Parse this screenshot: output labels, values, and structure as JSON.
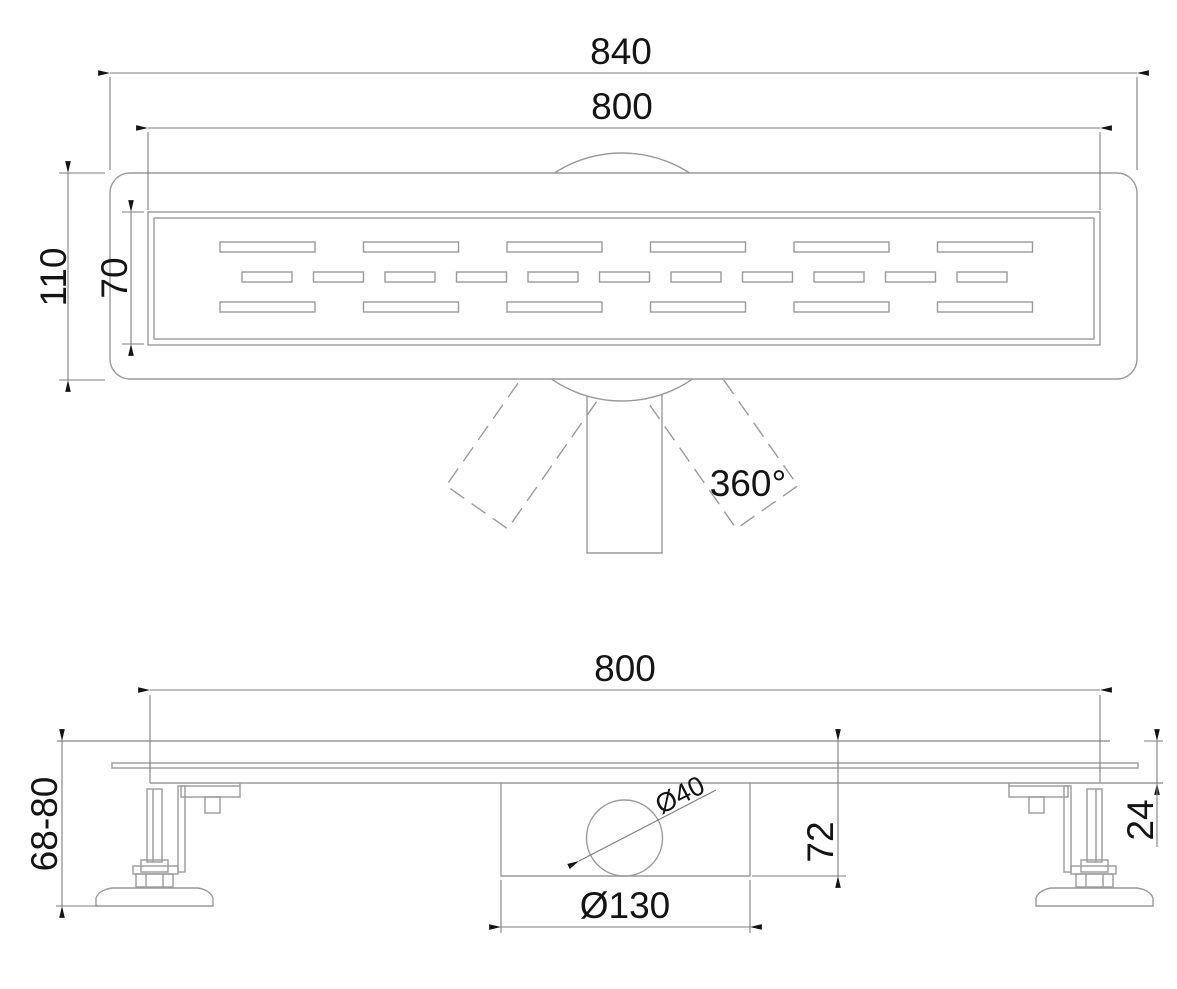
{
  "drawing": {
    "type": "technical-drawing",
    "subject": "linear shower drain with 360-degree rotatable outlet, top view and side section view",
    "colors": {
      "line": "#9a9a9a",
      "dimension_line": "#7d7d7d",
      "text": "#141414"
    },
    "top_view": {
      "labels": {
        "overall_length": "840",
        "grate_length": "800",
        "overall_width": "110",
        "grate_width": "70",
        "rotation": "360°"
      },
      "grate": {
        "long_slots_per_row": 6,
        "short_slots_per_row": 11,
        "rows": 3
      }
    },
    "side_view": {
      "labels": {
        "body_length": "800",
        "adjustable_height": "68-80",
        "trap_depth": "72",
        "channel_depth": "24",
        "outlet_diameter": "Ø40",
        "trap_diameter": "Ø130"
      }
    }
  }
}
